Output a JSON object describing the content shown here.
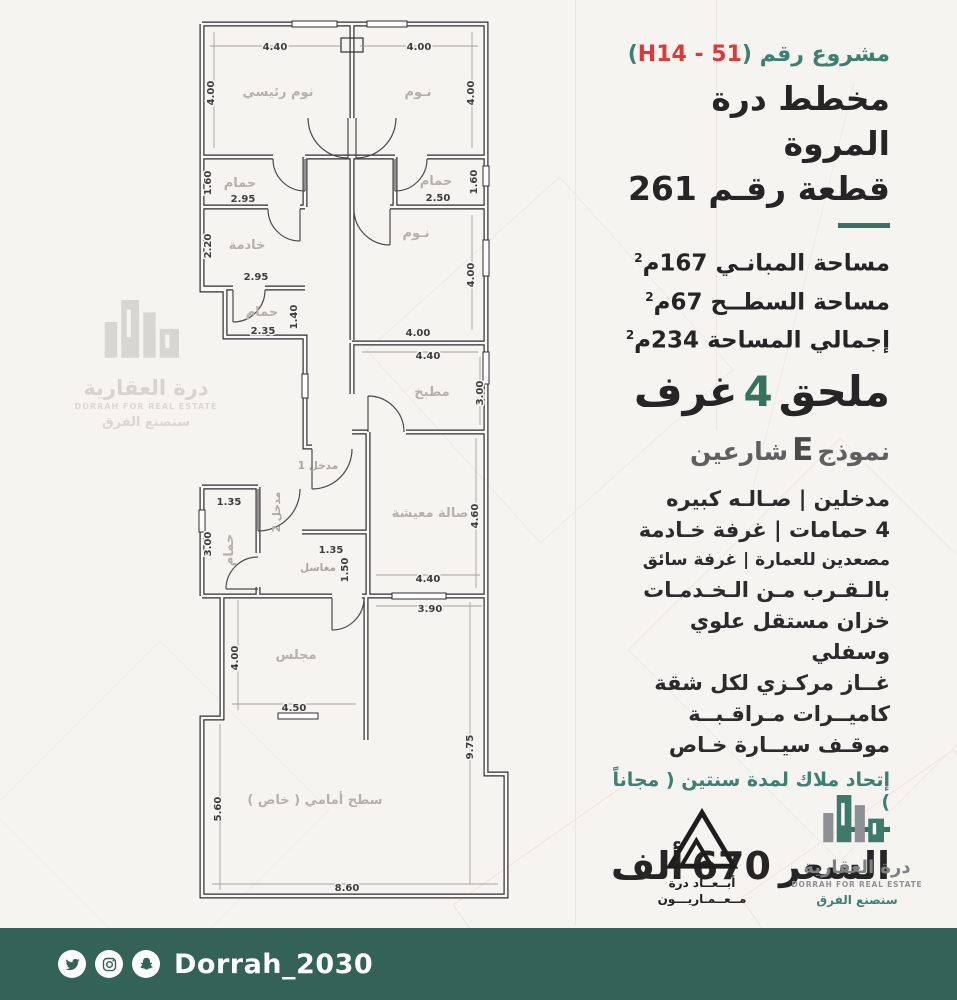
{
  "panel": {
    "project": {
      "label": "مشروع رقم",
      "paren_open": "(",
      "code": "H14 - 51",
      "paren_close": ")"
    },
    "title_line1": "مخطط درة المروة",
    "title_line2": "قطعة رقـم 261",
    "areas": [
      {
        "label": "مساحة المبانـي",
        "value": "167",
        "unit": "م",
        "sup": "2"
      },
      {
        "label": "مساحة السطــح",
        "value": "67",
        "unit": "م",
        "sup": "2"
      },
      {
        "label": "إجمالي المساحة",
        "value": "234",
        "unit": "م",
        "sup": "2"
      }
    ],
    "annex": {
      "word": "ملحق",
      "count": "4",
      "rooms": "غرف"
    },
    "model": {
      "prefix": "نموذج",
      "letter": "E",
      "suffix": "شارعين"
    },
    "features": [
      "مدخلين  |  صـالـه كبيره",
      "4 حمامات | غرفة خـادمة",
      "مصعدين للعمارة | غرفة سائق",
      "بالـقـرب مـن الـخـدمـات",
      "خزان مستقل علوي وسفلي",
      "غــاز مركـزي لكل شقة",
      "كاميــرات مـراقـبــة",
      "موقـف سيــارة خـاص"
    ],
    "hoa": "إتحاد ملاك لمدة سنتين ( مجاناً )",
    "price": {
      "label": "السعر",
      "value": "670",
      "unit": "ألف"
    }
  },
  "plan": {
    "rooms": {
      "master": "نوم رئيسي",
      "bed2": "نـوم",
      "bed3": "نـوم",
      "bath1": "حمام",
      "bath2": "حمام",
      "maid": "خادمة",
      "bath3": "حمام",
      "kitchen": "مطبخ",
      "entry1": "مدخل 1",
      "entry2": "مدخل 2",
      "bath4": "حمام",
      "sinks": "مغاسل",
      "living": "صالة معيشة",
      "majlis": "مجلس",
      "terrace": "سطح أمامي ( خاص )"
    },
    "dims": {
      "master_w": "4.40",
      "master_h": "4.00",
      "bed2_w": "4.00",
      "bed2_h": "4.00",
      "bath1_h": "1.60",
      "bath1_w": "2.95",
      "bath2_w": "2.50",
      "bath2_h": "1.60",
      "maid_h": "2.20",
      "maid_w": "2.95",
      "bath3_w": "2.35",
      "bath3_h": "1.40",
      "bed3_h": "4.00",
      "bed3_w": "4.00",
      "kitchen_w": "4.40",
      "kitchen_h": "3.00",
      "bath4_w": "1.35",
      "bath4_h": "3.00",
      "sinks_w": "1.35",
      "sinks_h": "1.50",
      "living_h": "4.60",
      "living_w": "4.40",
      "passage_w": "3.90",
      "majlis_h": "4.00",
      "majlis_w": "4.50",
      "terrace_side": "9.75",
      "terrace_h": "5.60",
      "terrace_w": "8.60"
    }
  },
  "watermark": {
    "name_ar": "درة العقارية",
    "name_en": "DORRAH FOR REAL ESTATE",
    "tagline": "سنصنع الفرق"
  },
  "logos": {
    "abaad": {
      "line1": "أبــعــاد درة",
      "line2": "مــعــمـاريـــون"
    },
    "dorrah": {
      "name_ar": "درة العقارية",
      "name_en": "DORRAH FOR REAL ESTATE",
      "tagline": "سنصنع الفرق"
    }
  },
  "footer": {
    "handle": "Dorrah_2030",
    "icons": [
      "twitter-icon",
      "instagram-icon",
      "snapchat-icon"
    ]
  },
  "colors": {
    "teal": "#3C8070",
    "teal_dark": "#336257",
    "red": "#E23737",
    "ink": "#252525"
  }
}
